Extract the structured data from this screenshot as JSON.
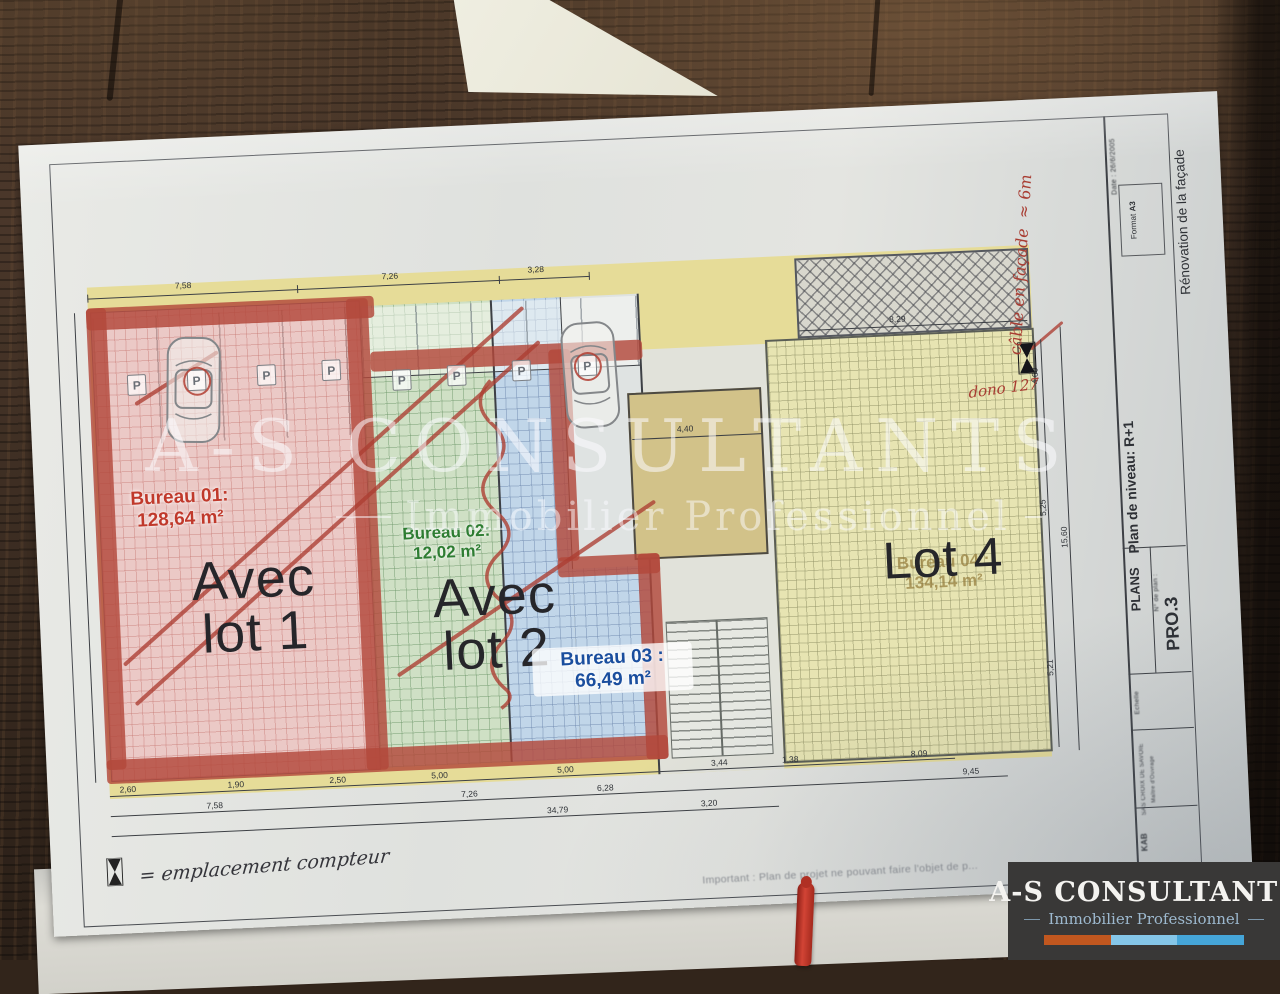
{
  "plan": {
    "lots": [
      {
        "bureau_label": "Bureau 01:",
        "area": "128,64 m²",
        "big1": "Avec",
        "big2": "lot 1"
      },
      {
        "bureau_label": "Bureau 02:",
        "area": "12,02 m²",
        "big1": "Avec",
        "big2": "lot 2"
      },
      {
        "bureau_label": "Bureau 03 :",
        "area": "66,49 m²"
      },
      {
        "bureau_label": "Bureau 04 :",
        "area": "134,14 m²",
        "big": "Lot 4"
      }
    ],
    "annotations": {
      "cable_line1": "câble en façade",
      "cable_line2": "≈ 6m",
      "dono": "dono 127",
      "legend_text": "= emplacement compteur",
      "important_note": "Important : Plan de projet ne pouvant faire l'objet de p",
      "parking_letter": "P"
    },
    "dimensions": {
      "top": [
        "7,58",
        "7,26",
        "3,28"
      ],
      "hatch": "8,29",
      "mid": "4,40",
      "right_vertical": [
        "4,60",
        "5,25",
        "15,60",
        "5,21"
      ],
      "bottom_row1": [
        "2,60",
        "1,90",
        "2,50",
        "5,00",
        "5,00",
        "3,44",
        "1,38",
        "8,09"
      ],
      "bottom_row2": [
        "7,58",
        "7,26",
        "6,28",
        "9,45"
      ],
      "bottom_row3": [
        "34,79",
        "3,20"
      ]
    }
  },
  "titleblock": {
    "project": "Rénovation de la façade",
    "level": "Plan de niveau: R+1",
    "category": "PLANS",
    "plan_no_label": "N° de plan :",
    "plan_no": "PRO.3",
    "format_label": "Format",
    "format": "A3",
    "date_label": "Date :",
    "date": "26/6/2005",
    "scale_label": "Echelle",
    "owner_label": "Maître d'Ouvrage",
    "client": "SAS CROIX DE SAVOIE",
    "author": "KAB"
  },
  "watermark": {
    "line1": "A-S CONSULTANTS",
    "line2": "Immobilier Professionnel"
  },
  "logo": {
    "name": "A-S CONSULTANTS",
    "tagline": "Immobilier Professionnel",
    "colors": {
      "orange": "#c1571f",
      "light_blue": "#85c6e8",
      "blue": "#45a5d8"
    }
  }
}
